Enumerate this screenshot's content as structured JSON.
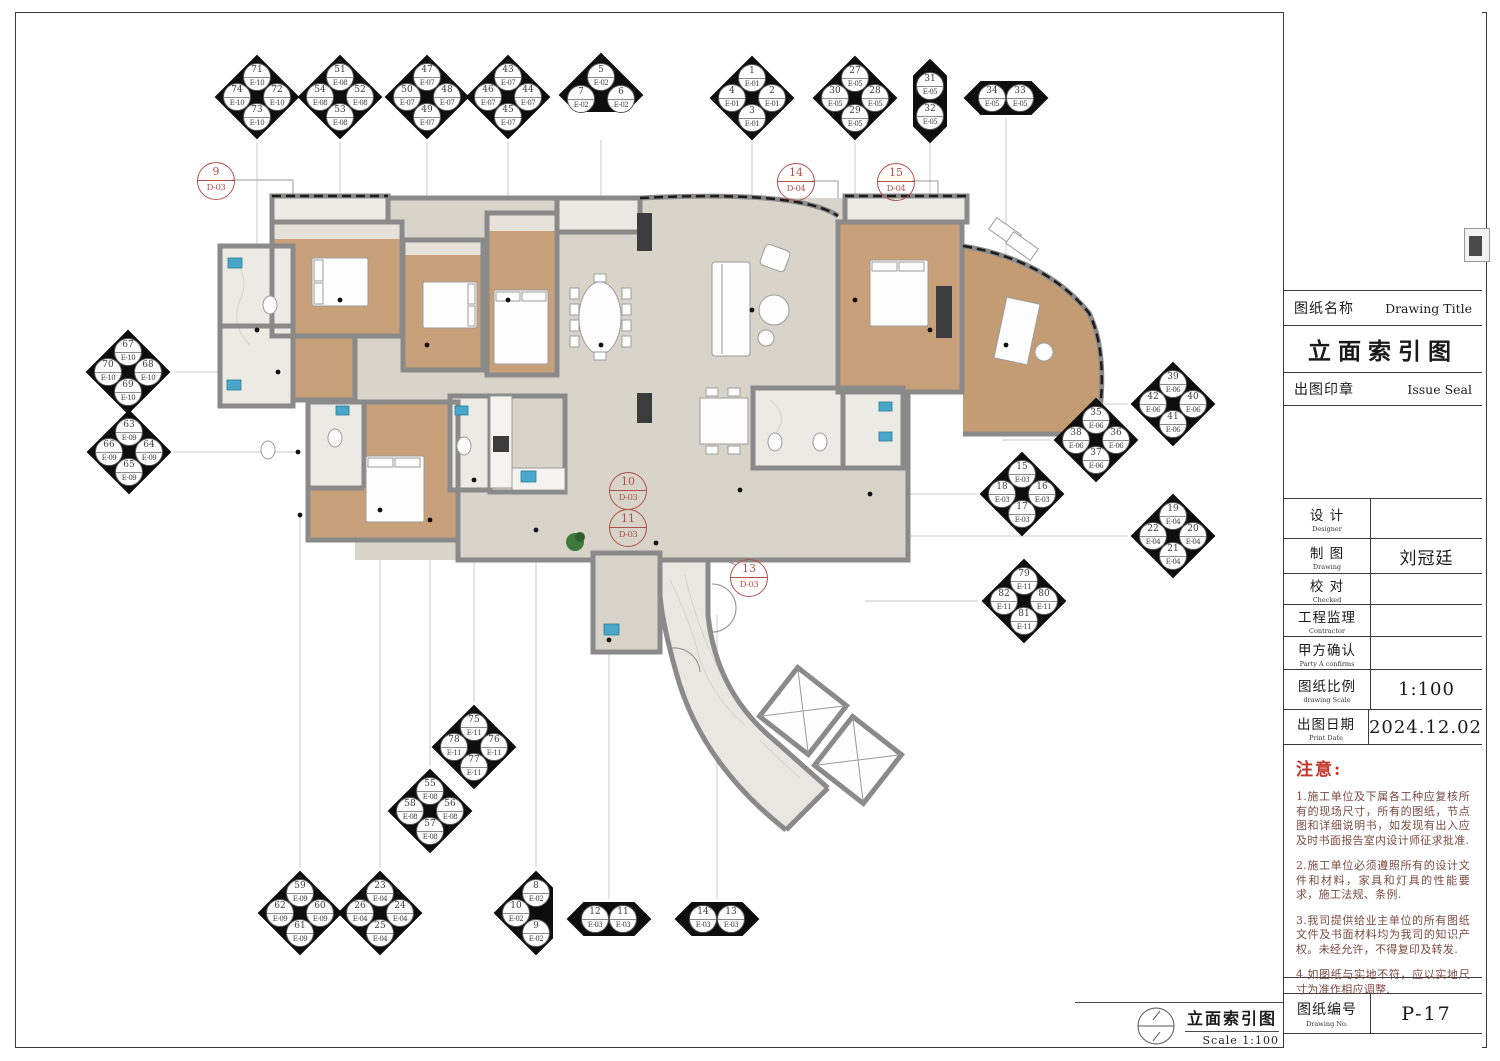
{
  "sheet": {
    "name_label": "图纸名称",
    "name_label_en": "Drawing Title",
    "title": "立面索引图",
    "seal_label": "出图印章",
    "seal_label_en": "Issue Seal",
    "fields": [
      {
        "label": "设 计",
        "en": "Designer",
        "value": ""
      },
      {
        "label": "制 图",
        "en": "Drawing",
        "value": "刘冠廷"
      },
      {
        "label": "校 对",
        "en": "Checked",
        "value": ""
      },
      {
        "label": "工程监理",
        "en": "Contractor",
        "value": ""
      },
      {
        "label": "甲方确认",
        "en": "Party A confirms",
        "value": ""
      },
      {
        "label": "图纸比例",
        "en": "drawing Scale",
        "value": "1:100"
      },
      {
        "label": "出图日期",
        "en": "Print Date",
        "value": "2024.12.02"
      }
    ],
    "notes_title": "注意:",
    "notes": [
      "1.施工单位及下属各工种应复核所有的现场尺寸，所有的图纸，节点图和详细说明书，如发现有出入应及时书面报告室内设计师征求批准.",
      "2.施工单位必须遵照所有的设计文件和材料，家具和灯具的性能要求，施工法规、条例.",
      "3.我司提供给业主单位的所有图纸文件及书面材料均为我司的知识产权。未经允许，不得复印及转发.",
      "4.如图纸与实地不符，应以实地尺寸为准作相应调整."
    ],
    "no_label": "图纸编号",
    "no_label_en": "Drawing No.",
    "number": "P-17"
  },
  "footer": {
    "title": "立面索引图",
    "scale": "Scale 1:100"
  },
  "colors": {
    "wall": "#8a8a8a",
    "wood": "#c8a17b",
    "floor": "#d8d4c9",
    "marble": "#eceae5",
    "fixture": "#49a8c9",
    "marker_red": "#b0524c",
    "note_red": "#c43529",
    "diamond": "#0e0e0e"
  },
  "elevation_markers": [
    {
      "type": "quad",
      "x": 257,
      "y": 97,
      "top": {
        "num": "71",
        "code": "E-10"
      },
      "right": {
        "num": "72",
        "code": "E-10"
      },
      "bottom": {
        "num": "73",
        "code": "E-10"
      },
      "left": {
        "num": "74",
        "code": "E-10"
      }
    },
    {
      "type": "quad",
      "x": 340,
      "y": 97,
      "top": {
        "num": "51",
        "code": "E-08"
      },
      "right": {
        "num": "52",
        "code": "E-08"
      },
      "bottom": {
        "num": "53",
        "code": "E-08"
      },
      "left": {
        "num": "54",
        "code": "E-08"
      }
    },
    {
      "type": "quad",
      "x": 427,
      "y": 97,
      "top": {
        "num": "47",
        "code": "E-07"
      },
      "right": {
        "num": "48",
        "code": "E-07"
      },
      "bottom": {
        "num": "49",
        "code": "E-07"
      },
      "left": {
        "num": "50",
        "code": "E-07"
      }
    },
    {
      "type": "quad",
      "x": 508,
      "y": 97,
      "top": {
        "num": "43",
        "code": "E-07"
      },
      "right": {
        "num": "44",
        "code": "E-07"
      },
      "bottom": {
        "num": "45",
        "code": "E-07"
      },
      "left": {
        "num": "46",
        "code": "E-07"
      }
    },
    {
      "type": "tri-top",
      "x": 601,
      "y": 95,
      "top": {
        "num": "5",
        "code": "E-02"
      },
      "right": {
        "num": "6",
        "code": "E-02"
      },
      "left": {
        "num": "7",
        "code": "E-02"
      }
    },
    {
      "type": "quad",
      "x": 752,
      "y": 98,
      "top": {
        "num": "1",
        "code": "E-01"
      },
      "right": {
        "num": "2",
        "code": "E-01"
      },
      "bottom": {
        "num": "3",
        "code": "E-01"
      },
      "left": {
        "num": "4",
        "code": "E-01"
      }
    },
    {
      "type": "quad",
      "x": 855,
      "y": 98,
      "top": {
        "num": "27",
        "code": "E-05"
      },
      "right": {
        "num": "28",
        "code": "E-05"
      },
      "bottom": {
        "num": "29",
        "code": "E-05"
      },
      "left": {
        "num": "30",
        "code": "E-05"
      }
    },
    {
      "type": "pair-v",
      "x": 930,
      "y": 101,
      "top": {
        "num": "31",
        "code": "E-05"
      },
      "bottom": {
        "num": "32",
        "code": "E-05"
      }
    },
    {
      "type": "pair-h",
      "x": 1006,
      "y": 98,
      "left": {
        "num": "34",
        "code": "E-05"
      },
      "right": {
        "num": "33",
        "code": "E-05"
      }
    },
    {
      "type": "quad",
      "x": 128,
      "y": 372,
      "top": {
        "num": "67",
        "code": "E-10"
      },
      "right": {
        "num": "68",
        "code": "E-10"
      },
      "bottom": {
        "num": "69",
        "code": "E-10"
      },
      "left": {
        "num": "70",
        "code": "E-10"
      }
    },
    {
      "type": "quad",
      "x": 129,
      "y": 452,
      "top": {
        "num": "63",
        "code": "E-09"
      },
      "right": {
        "num": "64",
        "code": "E-09"
      },
      "bottom": {
        "num": "65",
        "code": "E-09"
      },
      "left": {
        "num": "66",
        "code": "E-09"
      }
    },
    {
      "type": "quad",
      "x": 1173,
      "y": 404,
      "top": {
        "num": "39",
        "code": "E-06"
      },
      "right": {
        "num": "40",
        "code": "E-06"
      },
      "bottom": {
        "num": "41",
        "code": "E-06"
      },
      "left": {
        "num": "42",
        "code": "E-06"
      }
    },
    {
      "type": "quad",
      "x": 1096,
      "y": 440,
      "top": {
        "num": "35",
        "code": "E-06"
      },
      "right": {
        "num": "36",
        "code": "E-06"
      },
      "bottom": {
        "num": "37",
        "code": "E-06"
      },
      "left": {
        "num": "38",
        "code": "E-06"
      }
    },
    {
      "type": "quad",
      "x": 1022,
      "y": 494,
      "top": {
        "num": "15",
        "code": "E-03"
      },
      "right": {
        "num": "16",
        "code": "E-03"
      },
      "bottom": {
        "num": "17",
        "code": "E-03"
      },
      "left": {
        "num": "18",
        "code": "E-03"
      }
    },
    {
      "type": "quad",
      "x": 1173,
      "y": 536,
      "top": {
        "num": "19",
        "code": "E-04"
      },
      "right": {
        "num": "20",
        "code": "E-04"
      },
      "bottom": {
        "num": "21",
        "code": "E-04"
      },
      "left": {
        "num": "22",
        "code": "E-04"
      }
    },
    {
      "type": "quad",
      "x": 1024,
      "y": 601,
      "top": {
        "num": "79",
        "code": "E-11"
      },
      "right": {
        "num": "80",
        "code": "E-11"
      },
      "bottom": {
        "num": "81",
        "code": "E-11"
      },
      "left": {
        "num": "82",
        "code": "E-11"
      }
    },
    {
      "type": "quad",
      "x": 474,
      "y": 747,
      "top": {
        "num": "75",
        "code": "E-11"
      },
      "right": {
        "num": "76",
        "code": "E-11"
      },
      "bottom": {
        "num": "77",
        "code": "E-11"
      },
      "left": {
        "num": "78",
        "code": "E-11"
      }
    },
    {
      "type": "quad",
      "x": 430,
      "y": 811,
      "top": {
        "num": "55",
        "code": "E-08"
      },
      "right": {
        "num": "56",
        "code": "E-08"
      },
      "bottom": {
        "num": "57",
        "code": "E-08"
      },
      "left": {
        "num": "58",
        "code": "E-08"
      }
    },
    {
      "type": "quad",
      "x": 300,
      "y": 913,
      "top": {
        "num": "59",
        "code": "E-09"
      },
      "right": {
        "num": "60",
        "code": "E-09"
      },
      "bottom": {
        "num": "61",
        "code": "E-09"
      },
      "left": {
        "num": "62",
        "code": "E-09"
      }
    },
    {
      "type": "quad",
      "x": 380,
      "y": 913,
      "top": {
        "num": "23",
        "code": "E-04"
      },
      "right": {
        "num": "24",
        "code": "E-04"
      },
      "bottom": {
        "num": "25",
        "code": "E-04"
      },
      "left": {
        "num": "26",
        "code": "E-04"
      }
    },
    {
      "type": "tri-vert",
      "x": 536,
      "y": 913,
      "top": {
        "num": "8",
        "code": "E-02"
      },
      "left": {
        "num": "10",
        "code": "E-02"
      },
      "bottom": {
        "num": "9",
        "code": "E-02"
      }
    },
    {
      "type": "pair-h",
      "x": 609,
      "y": 919,
      "left": {
        "num": "12",
        "code": "E-03"
      },
      "right": {
        "num": "11",
        "code": "E-03"
      }
    },
    {
      "type": "pair-h",
      "x": 717,
      "y": 919,
      "left": {
        "num": "14",
        "code": "E-03"
      },
      "right": {
        "num": "13",
        "code": "E-03"
      }
    }
  ],
  "detail_markers": [
    {
      "num": "9",
      "code": "D-03",
      "x": 215,
      "y": 180
    },
    {
      "num": "14",
      "code": "D-04",
      "x": 795,
      "y": 181
    },
    {
      "num": "15",
      "code": "D-04",
      "x": 895,
      "y": 181
    },
    {
      "num": "10",
      "code": "D-03",
      "x": 627,
      "y": 490
    },
    {
      "num": "11",
      "code": "D-03",
      "x": 627,
      "y": 527
    },
    {
      "num": "13",
      "code": "D-03",
      "x": 748,
      "y": 577
    }
  ]
}
